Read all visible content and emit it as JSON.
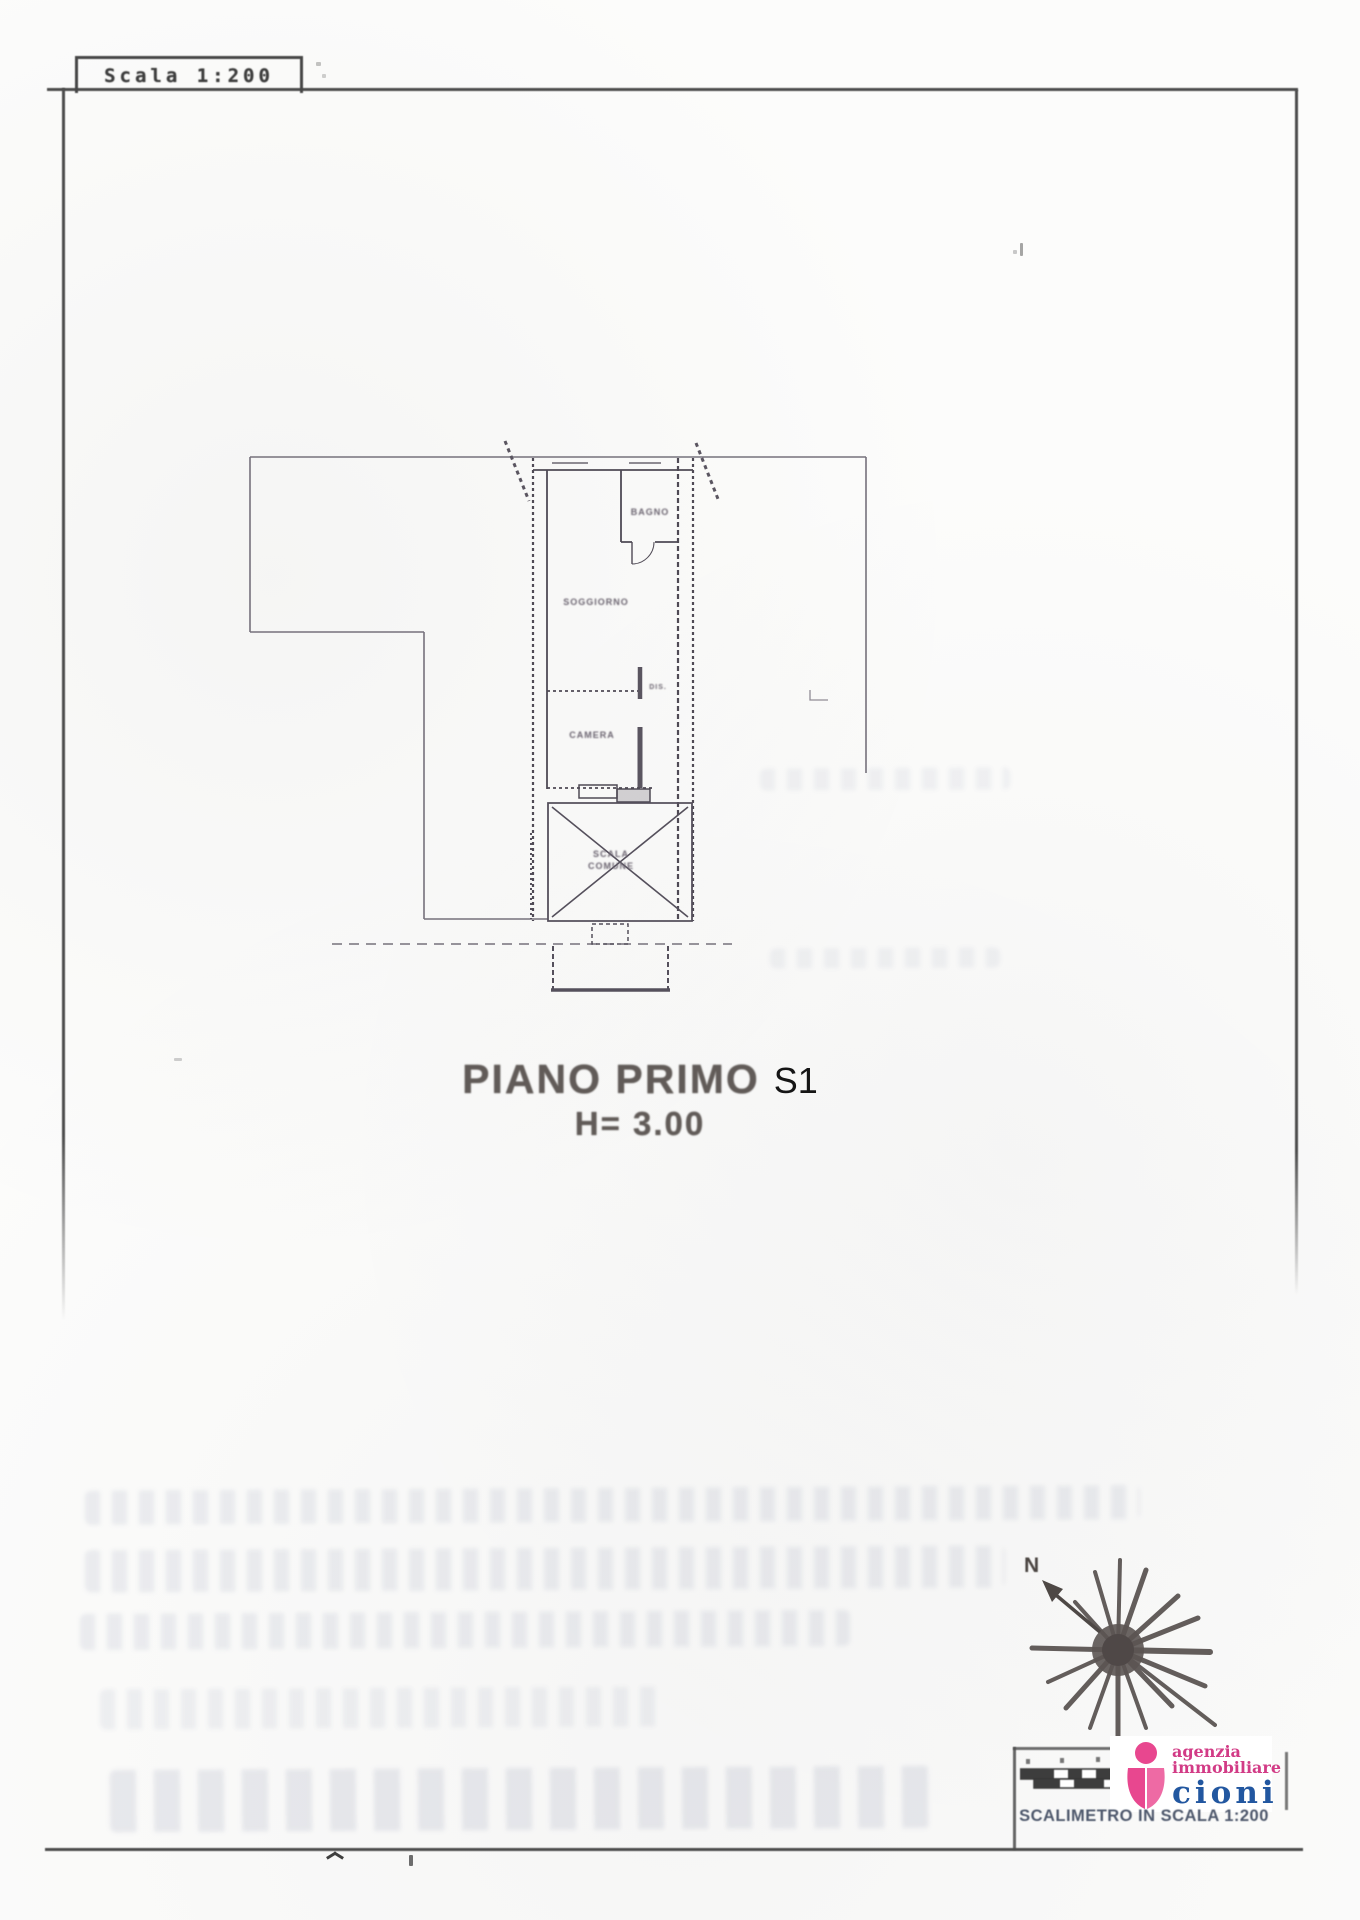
{
  "document": {
    "scale_box": "Scala 1:200",
    "plan_title": "PIANO PRIMO",
    "plan_title_suffix": "S1",
    "plan_height": "H= 3.00",
    "footer_caption": "SCALIMETRO IN SCALA 1:200"
  },
  "floor_plan": {
    "rooms": [
      {
        "label": "BAGNO"
      },
      {
        "label": "SOGGIORNO"
      },
      {
        "label": "DIS."
      },
      {
        "label": "CAMERA"
      },
      {
        "label": "SCALA COMUNE"
      }
    ]
  },
  "compass": {
    "north": "N"
  },
  "agency": {
    "line1": "agenzia",
    "line2": "immobiliare",
    "name": "cioni"
  },
  "colors": {
    "magenta": "#d23b86",
    "blue": "#2257a0",
    "ink": "#4d4d4d"
  }
}
